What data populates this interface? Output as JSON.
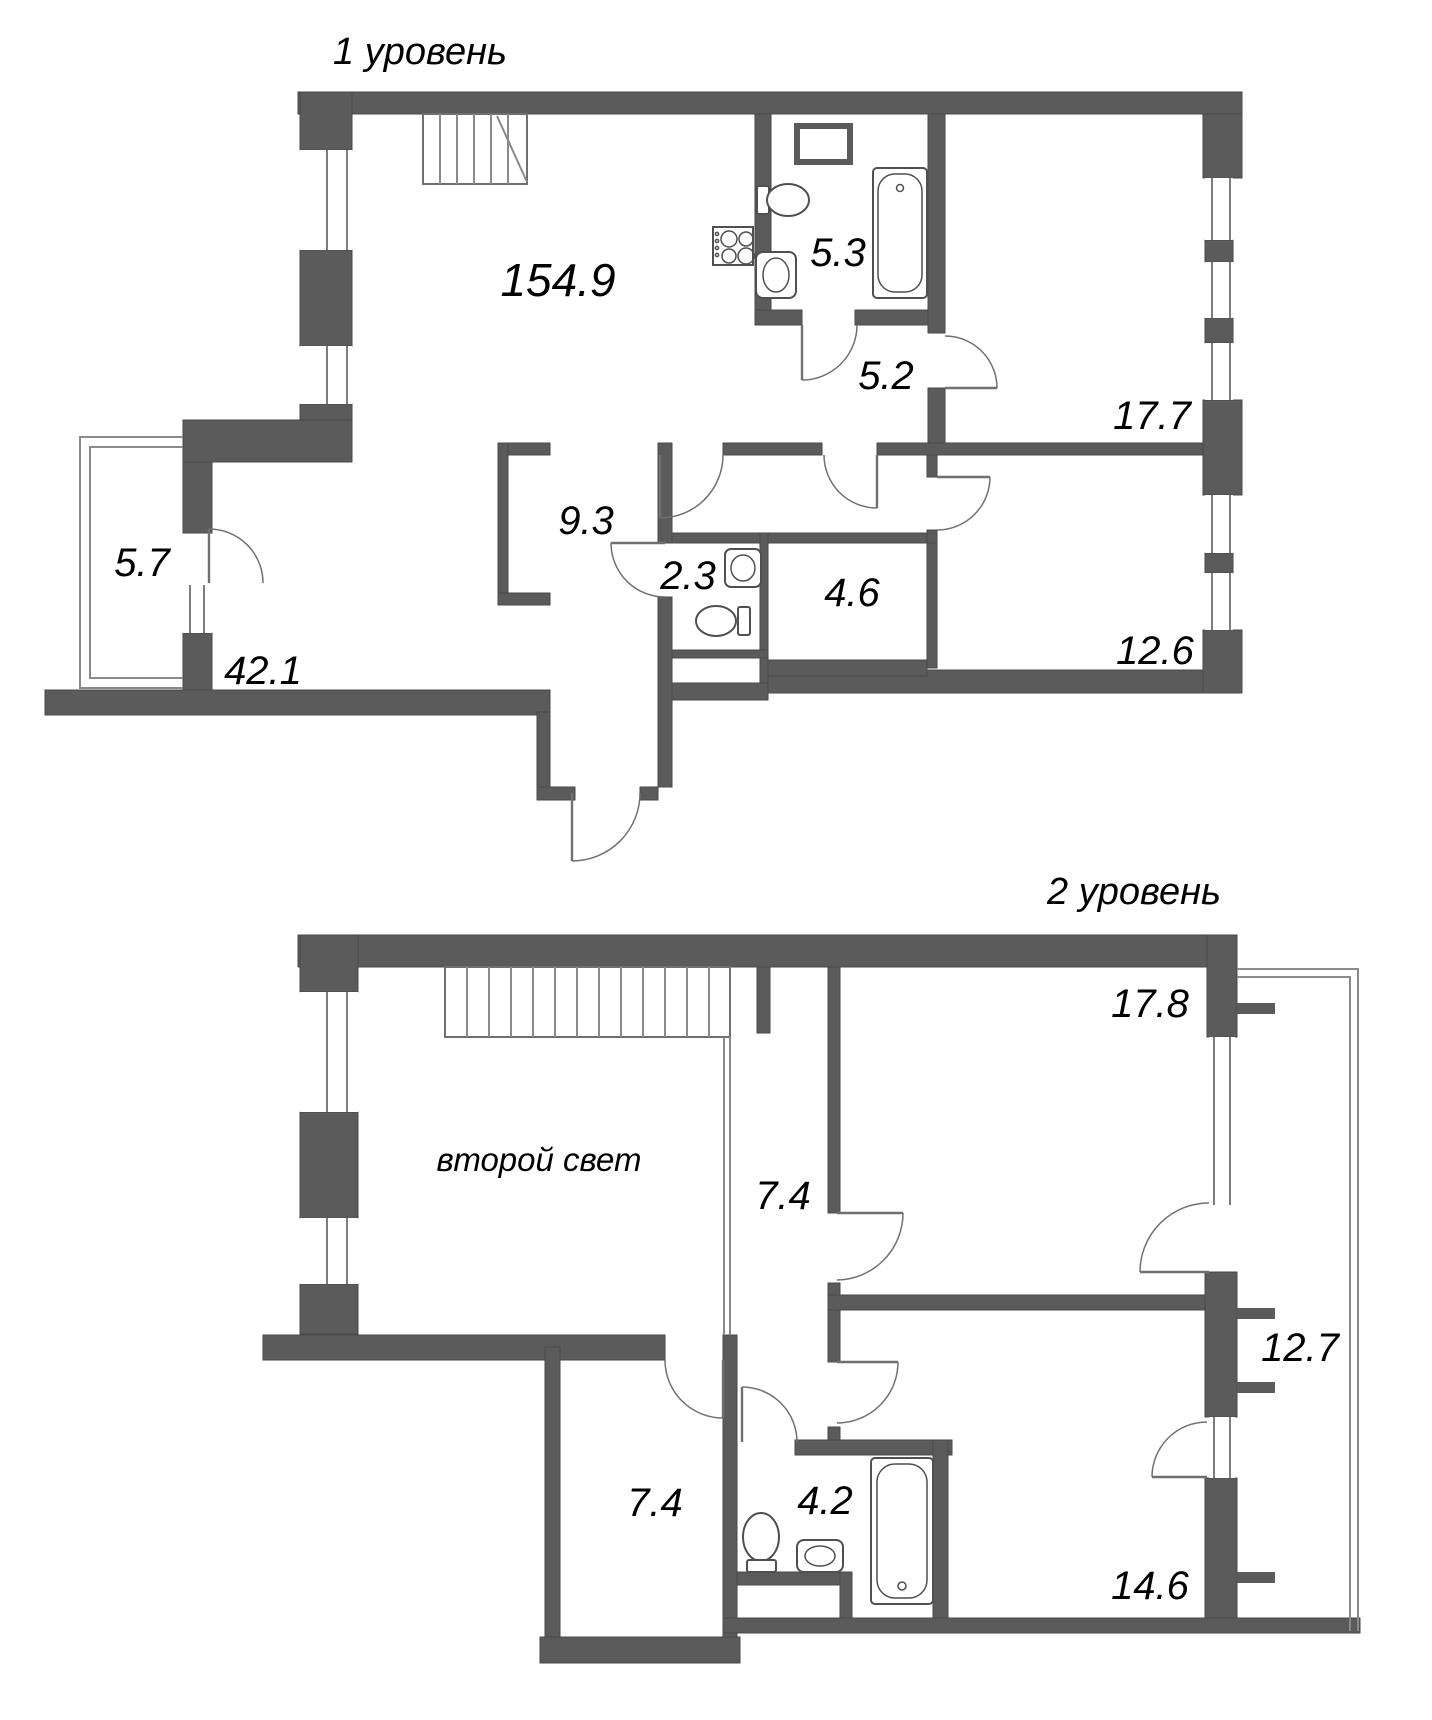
{
  "plan": {
    "colors": {
      "wall": "#5b5b5b",
      "background": "#ffffff",
      "line": "#7d7d7d",
      "text": "#000000"
    },
    "levels": [
      {
        "title": "1 уровень",
        "rooms": [
          {
            "name": "living-kitchen",
            "label": "154.9"
          },
          {
            "name": "bathroom",
            "label": "5.3"
          },
          {
            "name": "hall",
            "label": "5.2"
          },
          {
            "name": "bedroom-1",
            "label": "17.7"
          },
          {
            "name": "corridor",
            "label": "9.3"
          },
          {
            "name": "wc",
            "label": "2.3"
          },
          {
            "name": "storage",
            "label": "4.6"
          },
          {
            "name": "bedroom-2",
            "label": "12.6"
          },
          {
            "name": "balcony",
            "label": "5.7"
          },
          {
            "name": "living-lower",
            "label": "42.1"
          }
        ]
      },
      {
        "title": "2 уровень",
        "rooms": [
          {
            "name": "bedroom-3",
            "label": "17.8"
          },
          {
            "name": "double-height-void",
            "label": "второй свет"
          },
          {
            "name": "corridor-upper",
            "label": "7.4"
          },
          {
            "name": "balcony-upper",
            "label": "12.7"
          },
          {
            "name": "room-lower-left",
            "label": "7.4"
          },
          {
            "name": "bathroom-2",
            "label": "4.2"
          },
          {
            "name": "bedroom-4",
            "label": "14.6"
          }
        ]
      }
    ]
  }
}
